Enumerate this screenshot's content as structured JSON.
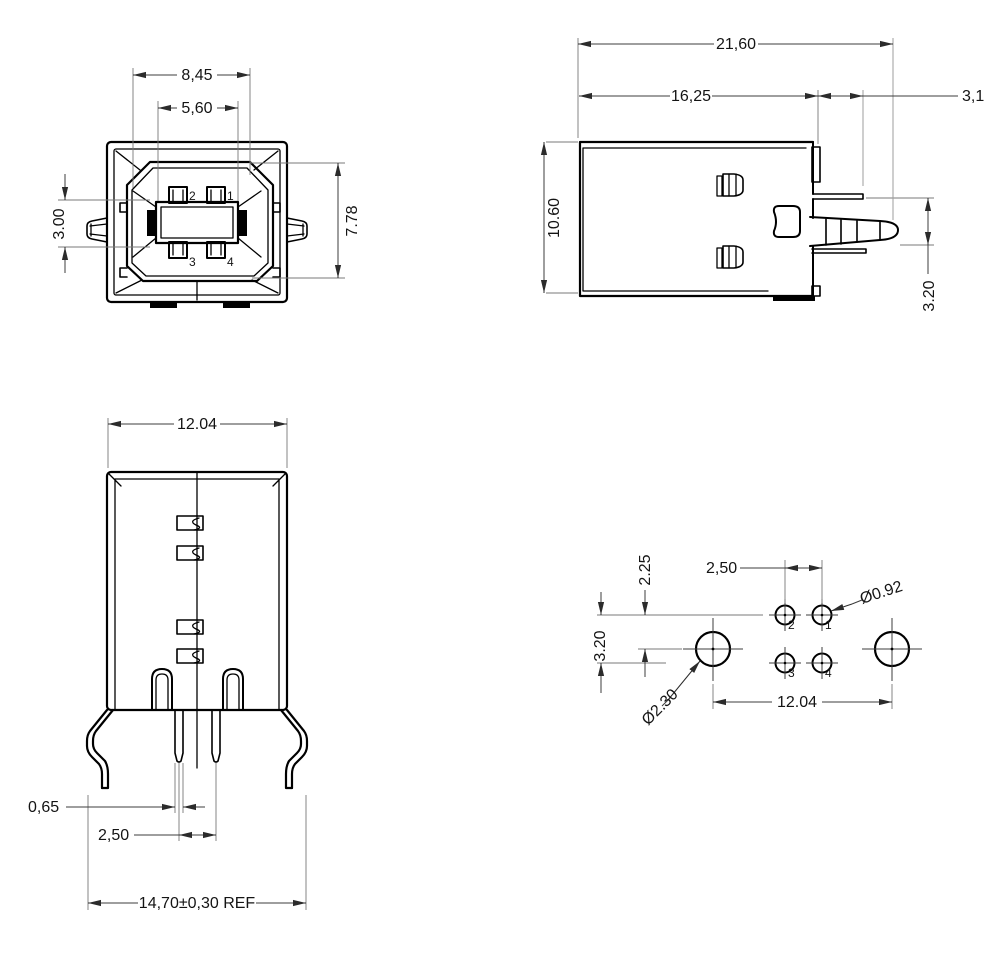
{
  "front_view": {
    "dim_width_outer": "8,45",
    "dim_width_tongue": "5,60",
    "dim_side_height": "3.00",
    "dim_shroud_height": "7.78",
    "pins": {
      "p1": "1",
      "p2": "2",
      "p3": "3",
      "p4": "4"
    }
  },
  "side_view": {
    "dim_overall_length": "21,60",
    "dim_body_length": "16,25",
    "dim_latch_offset": "3,1",
    "dim_height": "10.60",
    "dim_latch_height": "3.20"
  },
  "rear_view": {
    "dim_width": "12.04",
    "dim_pin_width": "0,65",
    "dim_pin_pitch": "2,50",
    "dim_leg_span": "14,70±0,30 REF"
  },
  "footprint_view": {
    "dim_row_offset": "2.25",
    "dim_row_spacing": "3.20",
    "dim_pin_pitch": "2,50",
    "dim_pin_hole_dia": "Ø0.92",
    "dim_mount_hole_dia": "Ø2.30",
    "dim_mount_pitch": "12.04",
    "pins": {
      "p1": "1",
      "p2": "2",
      "p3": "3",
      "p4": "4"
    }
  }
}
